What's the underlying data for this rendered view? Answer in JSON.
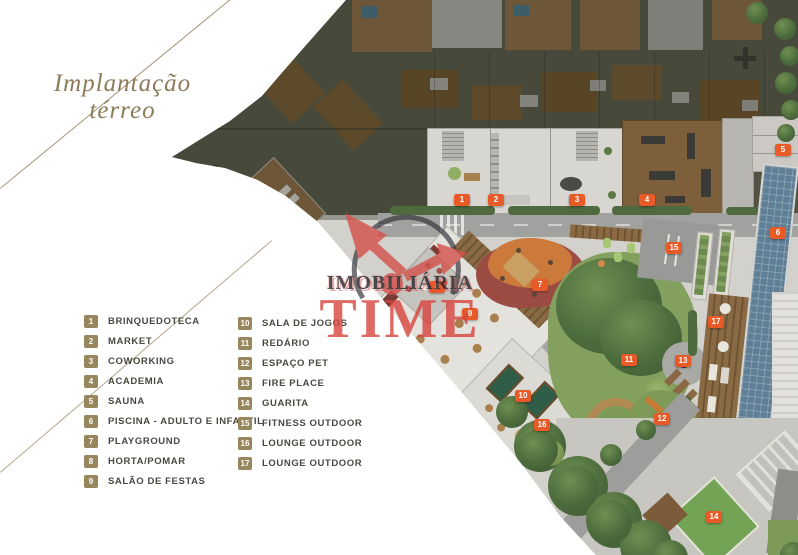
{
  "title": {
    "line1": "Implantação",
    "line2": "térreo"
  },
  "legend": {
    "column1": [
      {
        "n": "1",
        "label": "BRINQUEDOTECA"
      },
      {
        "n": "2",
        "label": "MARKET"
      },
      {
        "n": "3",
        "label": "COWORKING"
      },
      {
        "n": "4",
        "label": "ACADEMIA"
      },
      {
        "n": "5",
        "label": "SAUNA"
      },
      {
        "n": "6",
        "label": "PISCINA - ADULTO E INFANTIL"
      },
      {
        "n": "7",
        "label": "PLAYGROUND"
      },
      {
        "n": "8",
        "label": "HORTA/POMAR"
      },
      {
        "n": "9",
        "label": "SALÃO DE FESTAS"
      }
    ],
    "column2": [
      {
        "n": "10",
        "label": "SALA DE JOGOS"
      },
      {
        "n": "11",
        "label": "REDÁRIO"
      },
      {
        "n": "12",
        "label": "ESPAÇO PET"
      },
      {
        "n": "13",
        "label": "FIRE PLACE"
      },
      {
        "n": "14",
        "label": "GUARITA"
      },
      {
        "n": "15",
        "label": "FITNESS OUTDOOR"
      },
      {
        "n": "16",
        "label": "LOUNGE OUTDOOR"
      },
      {
        "n": "17",
        "label": "LOUNGE OUTDOOR"
      }
    ]
  },
  "plan_markers": [
    {
      "n": "1",
      "x": 462,
      "y": 200,
      "label": "BRINQUEDOTECA"
    },
    {
      "n": "2",
      "x": 496,
      "y": 200,
      "label": "MARKET"
    },
    {
      "n": "3",
      "x": 577,
      "y": 200,
      "label": "COWORKING"
    },
    {
      "n": "4",
      "x": 647,
      "y": 200,
      "label": "ACADEMIA"
    },
    {
      "n": "5",
      "x": 783,
      "y": 150,
      "label": "SAUNA"
    },
    {
      "n": "6",
      "x": 778,
      "y": 233,
      "label": "PISCINA - ADULTO E INFANTIL"
    },
    {
      "n": "7",
      "x": 540,
      "y": 285,
      "label": "PLAYGROUND"
    },
    {
      "n": "8",
      "x": 437,
      "y": 287,
      "label": "HORTA/POMAR"
    },
    {
      "n": "9",
      "x": 470,
      "y": 314,
      "label": "SALÃO DE FESTAS"
    },
    {
      "n": "10",
      "x": 523,
      "y": 396,
      "label": "SALA DE JOGOS"
    },
    {
      "n": "11",
      "x": 629,
      "y": 360,
      "label": "REDÁRIO"
    },
    {
      "n": "12",
      "x": 662,
      "y": 419,
      "label": "ESPAÇO PET"
    },
    {
      "n": "13",
      "x": 683,
      "y": 361,
      "label": "FIRE PLACE"
    },
    {
      "n": "14",
      "x": 714,
      "y": 517,
      "label": "GUARITA"
    },
    {
      "n": "15",
      "x": 674,
      "y": 248,
      "label": "FITNESS OUTDOOR"
    },
    {
      "n": "16",
      "x": 542,
      "y": 425,
      "label": "LOUNGE OUTDOOR"
    },
    {
      "n": "17",
      "x": 716,
      "y": 322,
      "label": "LOUNGE OUTDOOR"
    }
  ],
  "watermark": {
    "line1": "IMOBILIÁRIA",
    "line2": "TIME"
  },
  "colors": {
    "title_gold": "#8c7b58",
    "legend_badge_gold": "#97875c",
    "marker_orange": "#e85b28",
    "watermark_red": "#d8453e",
    "watermark_dark": "#23232c",
    "lawn_green": "#84a05e",
    "pool_blue": "#5f7f96"
  }
}
